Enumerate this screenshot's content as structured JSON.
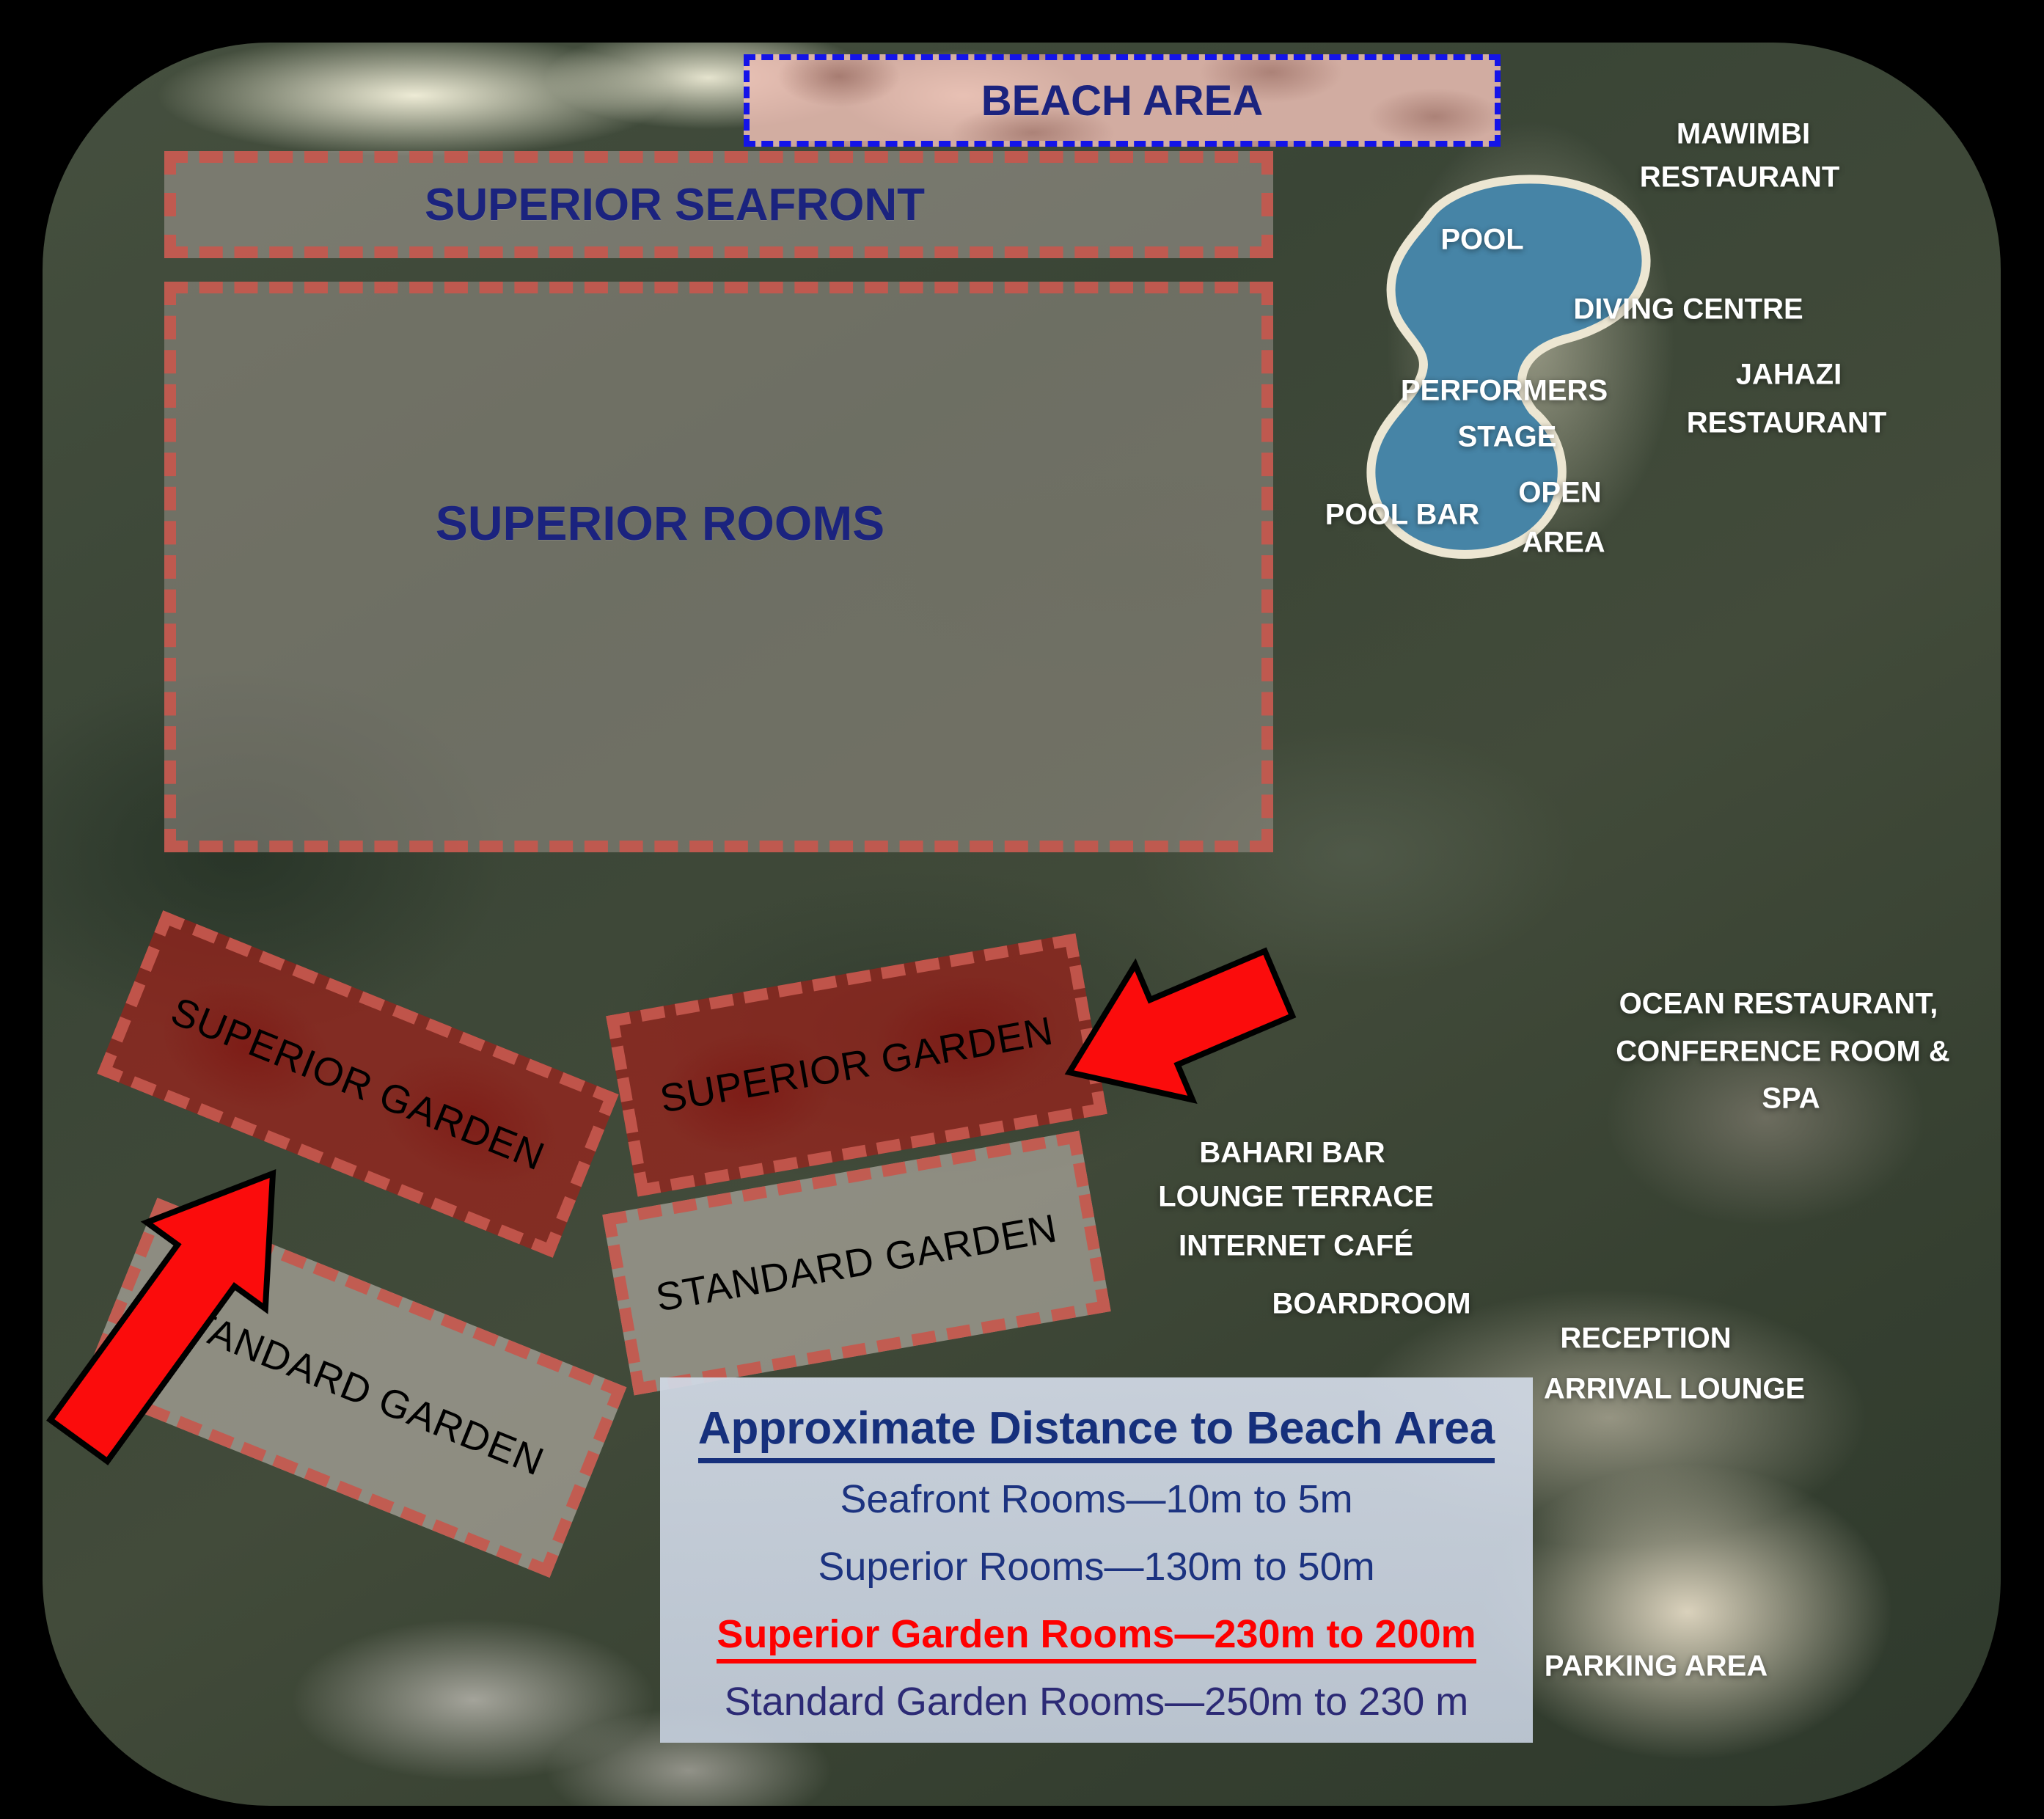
{
  "zones": {
    "beach_area": {
      "label": "BEACH AREA"
    },
    "superior_seafront": {
      "label": "SUPERIOR SEAFRONT"
    },
    "superior_rooms": {
      "label": "SUPERIOR ROOMS"
    },
    "superior_garden_left": {
      "label": "SUPERIOR GARDEN"
    },
    "superior_garden_right": {
      "label": "SUPERIOR GARDEN"
    },
    "standard_garden_left": {
      "label": "STANDARD GARDEN"
    },
    "standard_garden_right": {
      "label": "STANDARD GARDEN"
    }
  },
  "facilities": {
    "mawimbi": {
      "line1": "MAWIMBI",
      "line2": "RESTAURANT"
    },
    "pool": {
      "line1": "POOL"
    },
    "diving": {
      "line1": "DIVING CENTRE"
    },
    "performers": {
      "line1": "PERFORMERS",
      "line2": "STAGE"
    },
    "jahazi": {
      "line1": "JAHAZI",
      "line2": "RESTAURANT"
    },
    "pool_bar": {
      "line1": "POOL BAR"
    },
    "open_area": {
      "line1": "OPEN",
      "line2": "AREA"
    },
    "ocean": {
      "line1": "OCEAN RESTAURANT,",
      "line2": "CONFERENCE ROOM &",
      "line3": "SPA"
    },
    "bahari": {
      "line1": "BAHARI BAR",
      "line2": "LOUNGE TERRACE",
      "line3": "INTERNET CAFÉ"
    },
    "boardroom": {
      "line1": "BOARDROOM"
    },
    "reception": {
      "line1": "RECEPTION",
      "line2": "ARRIVAL LOUNGE"
    },
    "parking": {
      "line1": "PARKING AREA"
    }
  },
  "legend": {
    "title": "Approximate Distance to Beach Area",
    "rows": [
      {
        "text": "Seafront Rooms—10m to 5m",
        "style": "normal"
      },
      {
        "text": "Superior Rooms—130m to 50m",
        "style": "normal"
      },
      {
        "text": "Superior Garden Rooms—230m to 200m",
        "style": "highlight"
      },
      {
        "text": "Standard Garden Rooms—250m to 230 m",
        "style": "normal"
      }
    ]
  },
  "icons": {
    "arrow_left": "red-arrow-pointing-upper-right",
    "arrow_right": "red-arrow-pointing-left"
  },
  "colors": {
    "label_navy": "#1b237e",
    "zone_dash_red": "#c6584e",
    "garden_fill_red": "#ac1c16",
    "beach_dash_blue": "#1414e8",
    "facility_white": "#ffffff",
    "arrow_red": "#fb0c0c",
    "legend_red": "#fe0000",
    "legend_bg": "#ccd4e0"
  }
}
